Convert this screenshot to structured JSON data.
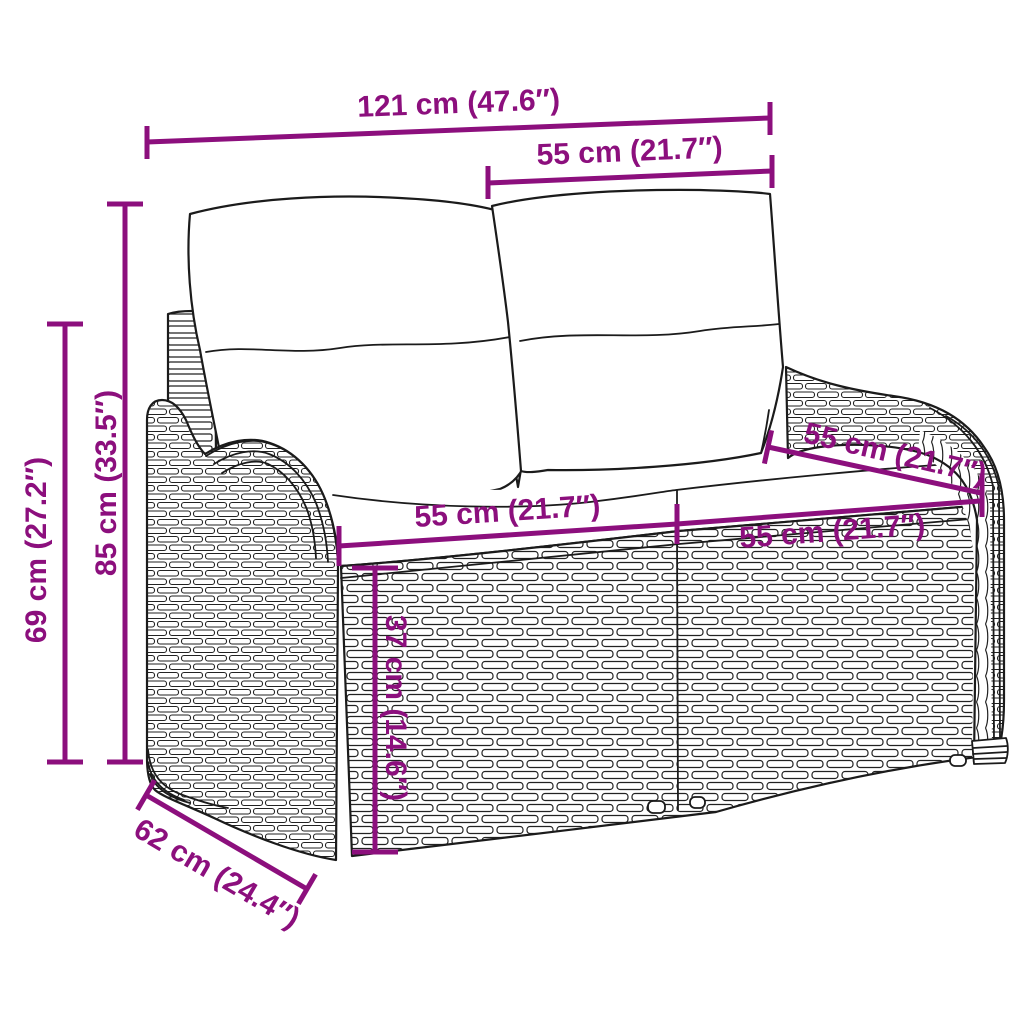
{
  "colors": {
    "background": "#ffffff",
    "line_art": "#1b1b1b",
    "dimension": "#8C0F7D"
  },
  "illustration": {
    "subject": "two-seater poly rattan garden bench with back pillows and seat cushions",
    "parts": [
      "back-cushion-left",
      "back-cushion-right",
      "back-post-left",
      "back-post-center",
      "seat-cushions",
      "wicker-base",
      "left-armrest",
      "right-armrest",
      "feet"
    ]
  },
  "dimensions": {
    "width_total": {
      "label": "121 cm (47.6″)"
    },
    "back_section_width": {
      "label": "55 cm (21.7″)"
    },
    "height_back": {
      "label": "85 cm (33.5″)"
    },
    "height_arm": {
      "label": "69 cm (27.2″)"
    },
    "seat_width_left": {
      "label": "55 cm (21.7″)"
    },
    "seat_width_right": {
      "label": "55 cm (21.7″)"
    },
    "seat_depth": {
      "label": "55 cm (21.7″)"
    },
    "seat_height": {
      "label": "37 cm (14.6″)"
    },
    "depth_total": {
      "label": "62 cm (24.4″)"
    }
  }
}
